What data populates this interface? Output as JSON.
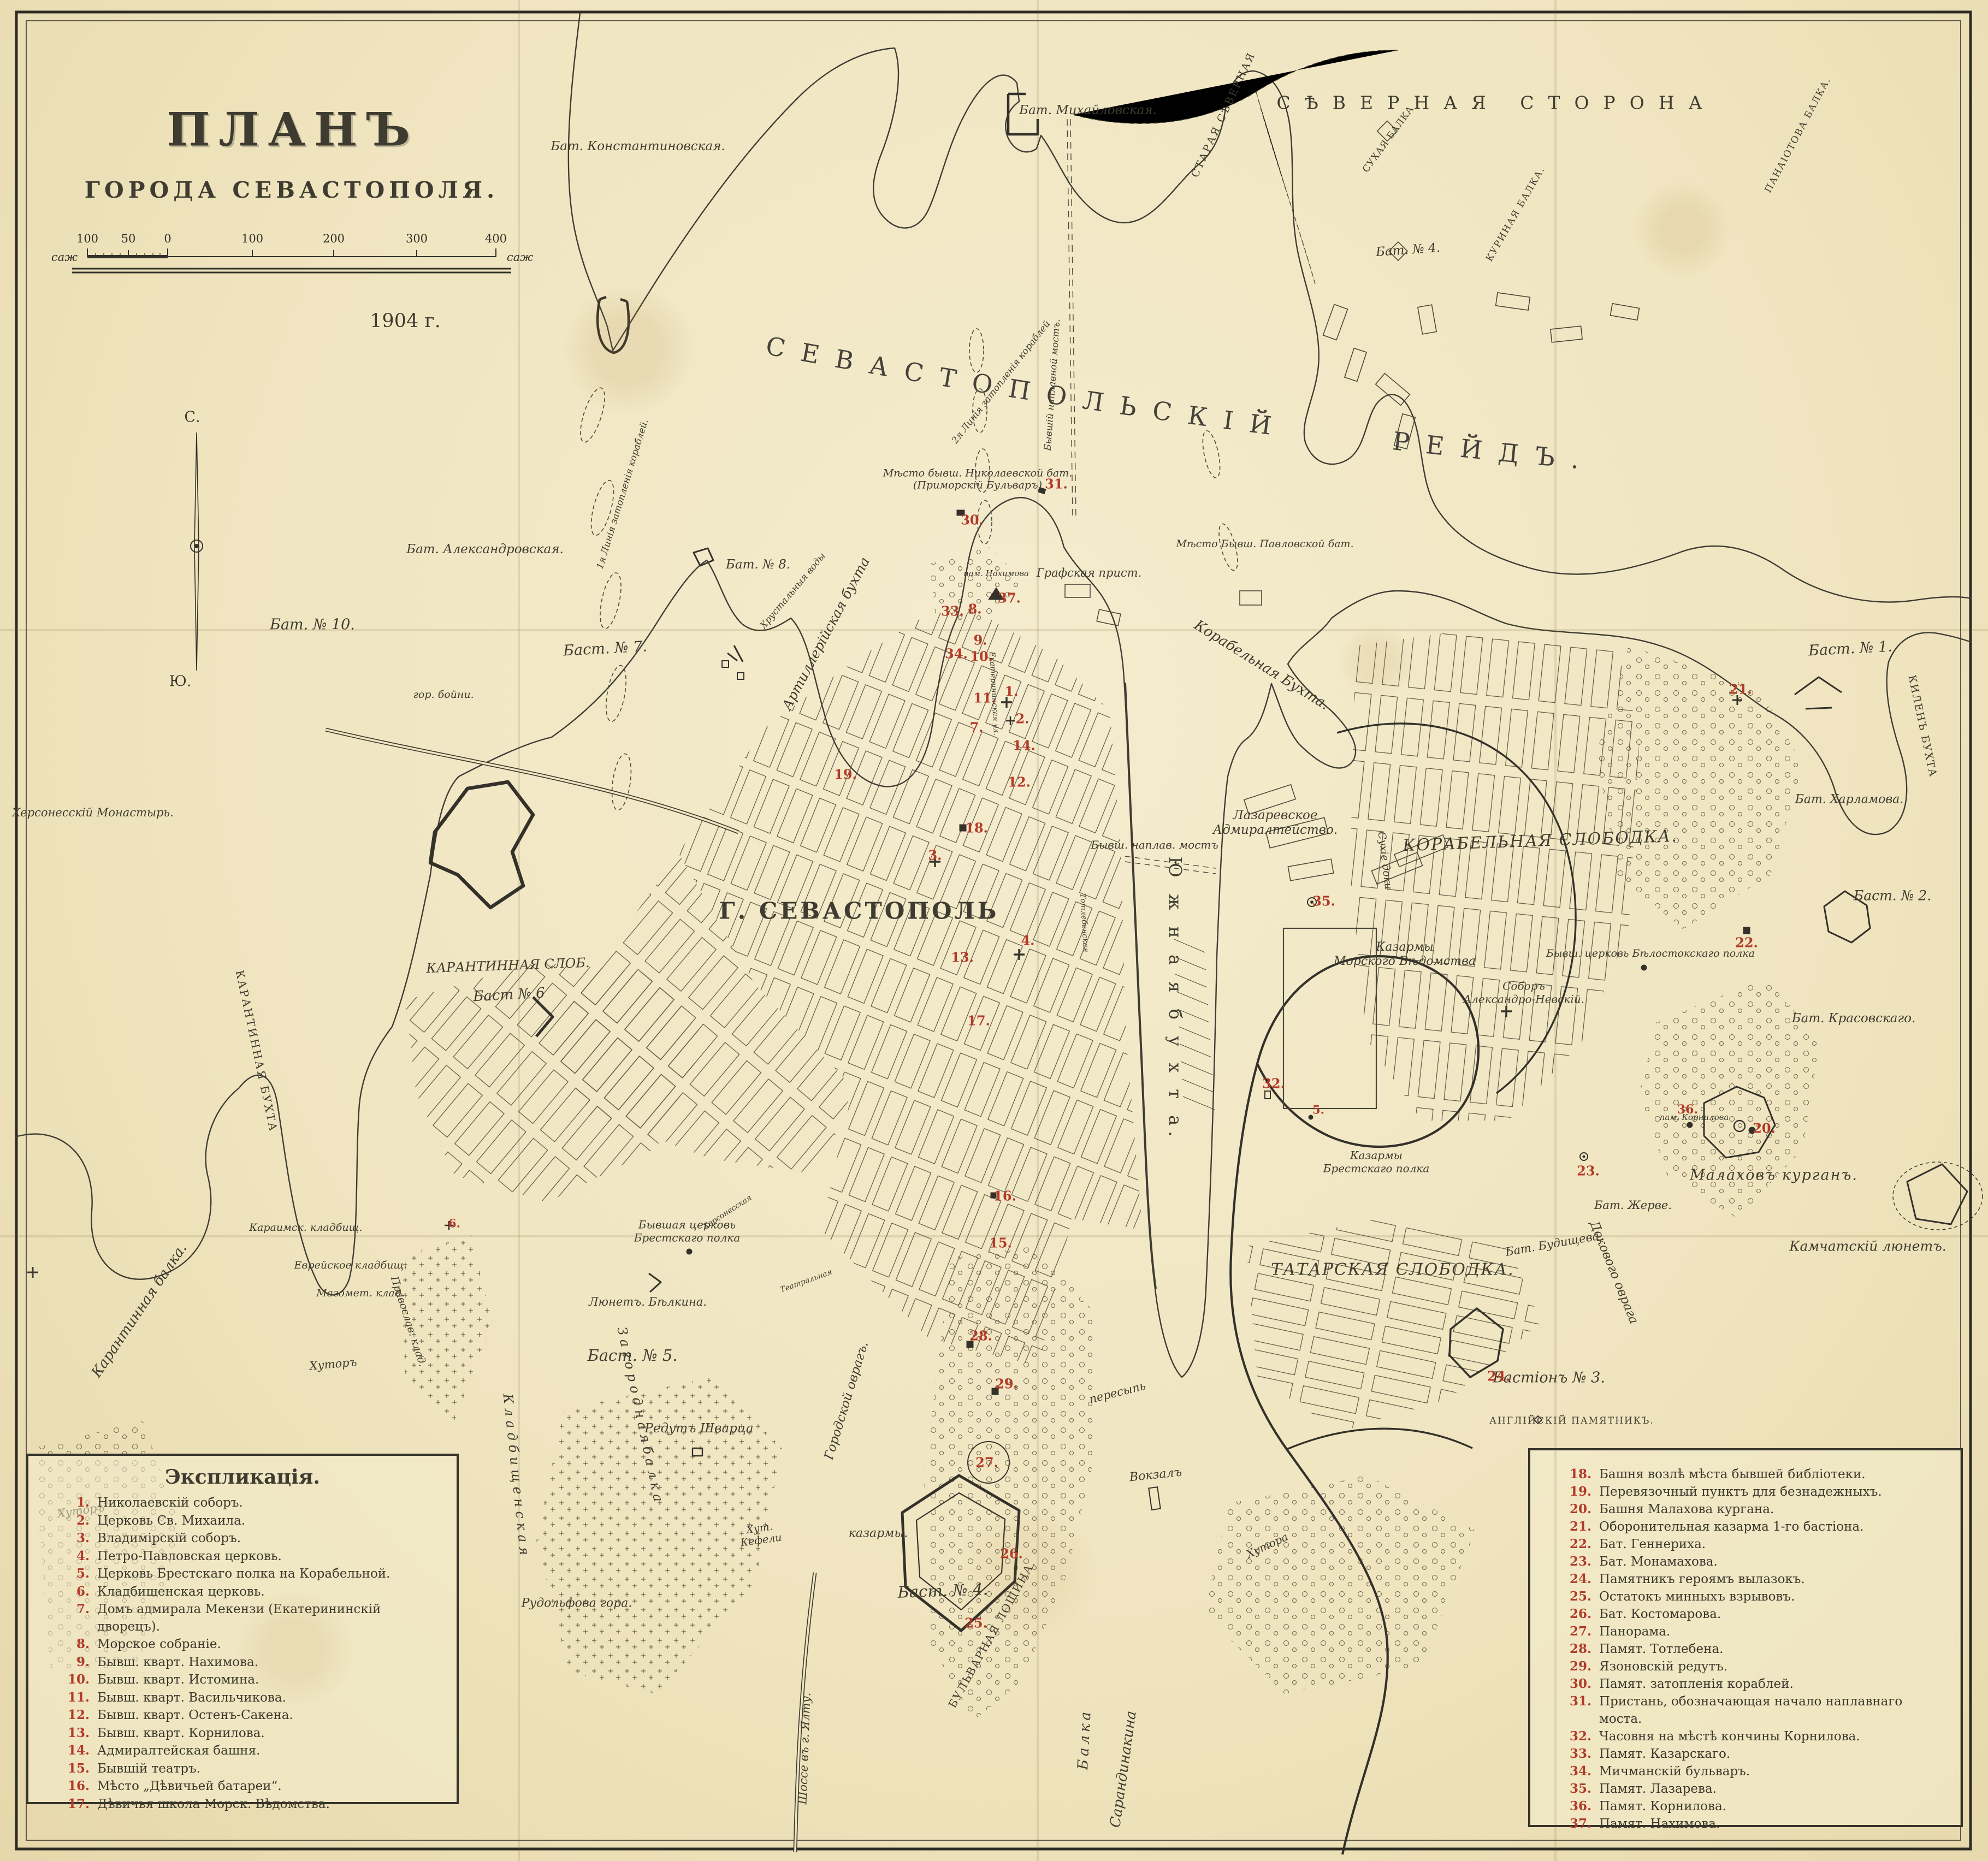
{
  "title": {
    "line1": "ПЛАНЪ",
    "line2": "ГОРОДА  СЕВАСТОПОЛЯ.",
    "year": "1904 г."
  },
  "scale_bar": {
    "unit_left": "саж",
    "unit_right": "саж",
    "ticks": [
      "100",
      "50",
      "0",
      "100",
      "200",
      "300",
      "400"
    ]
  },
  "compass": {
    "north": "С.",
    "south": "Ю."
  },
  "sea": {
    "reyd": "СЕВАСТОПОЛЬСКІЙ РЕЙДЪ.",
    "severnaya": "СѢВЕРНАЯ  СТОРОНА",
    "staraya": "СТАРАЯ СѢВЕРНАЯ"
  },
  "map_labels": {
    "g_sevastopol": "Г. СЕВАСТОПОЛЬ",
    "korabelnaya_slobodka": "КОРАБЕЛЬНАЯ  СЛОБОДКА.",
    "tatarskaya_slobodka": "ТАТАРСКАЯ  СЛОБОДКА.",
    "karantinnaya_slob": "КАРАНТИННАЯ СЛОБ.",
    "yuzhnaya_bukhta": "Ю ж н а я     б у х т а.",
    "korabelnaya_bukhta": "Корабельная  Бухта.",
    "artilleriyskaya_bukhta": "Артиллерійская бухта",
    "karantinnaya_bukhta": "КАРАНТИННАЯ  БУХТА",
    "kilen_bukhta": "КИЛЕНЪ  БУХТА",
    "karantinnaya_balka": "Карантинная  балка.",
    "suhaya_balka": "СУХАЯ БАЛКА",
    "kurinaya_balka": "КУРИНАЯ БАЛКА.",
    "panaiotova_balka": "ПАНАІОТОВА БАЛКА.",
    "balka_sarandi_1": "Балка",
    "balka_sarandi_2": "Сарандинакина",
    "zagorodnaya_balka": "З а г о р о д н а я   б а л к а",
    "kladbishchenskaya": "К л а д б и щ е н с к а я",
    "gorodskoy_ovrag": "Городской оврагъ.",
    "dokovogo_ovraga": "Докового оврага",
    "bulvarnaya_loshchina": "БУЛЬВАРНАЯ  ЛОЩИНА.",
    "peresyp": "пересыпь",
    "khrustalnye_vody": "Хрустальныя воды",
    "bat_konstantinovskaya": "Бат. Константиновская.",
    "bat_mikhailovskaya": "Бат. Михайловская.",
    "bat_n4_north": "Бат. № 4.",
    "bat_aleksandrovskaya": "Бат. Александровская.",
    "bat_n10": "Бат. № 10.",
    "bast_n7": "Баст. № 7.",
    "bat_n8": "Бат. № 8.",
    "gor_boyni": "гор. бойни.",
    "bast_n6": "Баст № 6",
    "bast_n5": "Баст. № 5.",
    "bast_n4": "Баст. № 4.",
    "bastion_n3": "Бастіонъ № 3.",
    "bast_n1": "Баст. № 1.",
    "bast_n2": "Баст. № 2.",
    "bat_kharlamova": "Бат. Харламова.",
    "bat_krasovskago": "Бат. Красовскаго.",
    "bat_zherve": "Бат. Жерве.",
    "bat_budishcheva": "Бат. Будищева",
    "malakhov_kurgan": "Малаховъ  курганъ.",
    "kamchatsky_lyunet": "Камчатскій  люнетъ.",
    "anglysky_pamyatnik": "АНГЛІЙСКІЙ  ПАМЯТНИКЪ.",
    "lyunet_belkina": "Люнетъ. Бѣлкина.",
    "redut_shvartsa": "Редутъ  Шварца",
    "mesto_nikolaevskoy": "Мѣсто бывш. Николаевской бат.\n(Приморскій Бульваръ)",
    "mesto_pavlovskoy": "Мѣсто Бывш. Павловской бат.",
    "grafskaya_prist": "Графская прист.",
    "pam_nakhimova": "пам. Нахимова",
    "pam_kornilova": "пам. Корнилова",
    "khersonessky_monastyr": "Херсонесскій  Монастырь.",
    "lazarevskoe": "Лазаревское\nАдмиралтейство.",
    "suhie_doki": "Сухіе  доки",
    "kazarmy_morskogo": "Казармы\nМорского Вѣдомства",
    "sobor_aleks_nevsky": "Соборъ\nАлександро-Невскій.",
    "tserkov_belostok": "Бывш. церковь Бѣлостокскаго полка",
    "kazarmy_brest": "Казармы\nБрестскаго полка",
    "tserkov_brest": "Бывшая церковь\nБрестскаго полка",
    "kazarmy_south": "казармы.",
    "vokzal": "Вокзалъ",
    "hutor_kefeli": "Хут.\nКефели",
    "rudolfova_gora": "Рудольфова гора.",
    "hutor_1": "Хуторъ",
    "hutor_2": "Хуторъ",
    "hutora": "Хутора",
    "karaimsk_kladb": "Караимск. кладбищ.",
    "evreyskoe_kladb": "Еврейское кладбищ.",
    "magomet_klad": "Магомет. клад.",
    "pravoslav_klad": "Православ. клад.",
    "shosse_yalta": "Шоссе въ г. Ялту.",
    "liniya1": "1я Линія затопленія кораблей.",
    "liniya2": "2я Линія затопленія кораблей",
    "naplavnoy_most_v": "Бывшій наплавной мостъ.",
    "naplav_most_s": "Бывш. наплав. мостъ",
    "ekaterininskaya": "Екатерининская  ул.",
    "khersonesskaya_ul": "Херсонесская",
    "teatralnaya_ul": "Театральная",
    "totlebenskaya_ul": "Тотлебенская"
  },
  "markers": {
    "m1": "1.",
    "m2": "2.",
    "m3": "3.",
    "m4": "4.",
    "m5": "5.",
    "m6": "6.",
    "m7": "7.",
    "m8": "8.",
    "m9": "9.",
    "m10": "10.",
    "m11": "11.",
    "m12": "12.",
    "m13": "13.",
    "m14": "14.",
    "m15": "15.",
    "m16": "16.",
    "m17": "17.",
    "m18": "18.",
    "m19": "19.",
    "m20": "20.",
    "m21": "21.",
    "m22": "22.",
    "m23": "23.",
    "m24": "24.",
    "m25": "25.",
    "m26": "26.",
    "m27": "27.",
    "m28": "28.",
    "m29": "29.",
    "m30": "30.",
    "m31": "31.",
    "m32": "32.",
    "m33": "33.",
    "m34": "34.",
    "m35": "35.",
    "m36": "36.",
    "m37": "37."
  },
  "legend_left": {
    "title": "Экспликація.",
    "items": [
      {
        "n": "1.",
        "text": "Николаевскій соборъ."
      },
      {
        "n": "2.",
        "text": "Церковь Св. Михаила."
      },
      {
        "n": "3.",
        "text": "Владимірскій соборъ."
      },
      {
        "n": "4.",
        "text": "Петро-Павловская церковь."
      },
      {
        "n": "5.",
        "text": "Церковь Брестскаго полка на Корабельной."
      },
      {
        "n": "6.",
        "text": "Кладбищенская церковь."
      },
      {
        "n": "7.",
        "text": "Домъ адмирала Мекензи (Екатерининскій дворецъ)."
      },
      {
        "n": "8.",
        "text": "Морское собраніе."
      },
      {
        "n": "9.",
        "text": "Бывш. кварт. Нахимова."
      },
      {
        "n": "10.",
        "text": "Бывш. кварт. Истомина."
      },
      {
        "n": "11.",
        "text": "Бывш. кварт. Васильчикова."
      },
      {
        "n": "12.",
        "text": "Бывш. кварт. Остенъ-Сакена."
      },
      {
        "n": "13.",
        "text": "Бывш. кварт. Корнилова."
      },
      {
        "n": "14.",
        "text": "Адмиралтейская башня."
      },
      {
        "n": "15.",
        "text": "Бывшій театръ."
      },
      {
        "n": "16.",
        "text": "Мѣсто „Дѣвичьей батареи“."
      },
      {
        "n": "17.",
        "text": "Дѣвичья школа Морск. Вѣдомства."
      }
    ]
  },
  "legend_right": {
    "items": [
      {
        "n": "18.",
        "text": "Башня возлѣ мѣста бывшей библіотеки."
      },
      {
        "n": "19.",
        "text": "Перевязочный пунктъ для безнадежныхъ."
      },
      {
        "n": "20.",
        "text": "Башня Малахова кургана."
      },
      {
        "n": "21.",
        "text": "Оборонительная казарма 1-го бастіона."
      },
      {
        "n": "22.",
        "text": "Бат. Геннериха."
      },
      {
        "n": "23.",
        "text": "Бат. Монамахова."
      },
      {
        "n": "24.",
        "text": "Памятникъ героямъ вылазокъ."
      },
      {
        "n": "25.",
        "text": "Остатокъ минныхъ взрывовъ."
      },
      {
        "n": "26.",
        "text": "Бат. Костомарова."
      },
      {
        "n": "27.",
        "text": "Панорама."
      },
      {
        "n": "28.",
        "text": "Памят. Тотлебена."
      },
      {
        "n": "29.",
        "text": "Язоновскій редутъ."
      },
      {
        "n": "30.",
        "text": "Памят. затопленія кораблей."
      },
      {
        "n": "31.",
        "text": "Пристань, обозначающая начало наплавнаго моста."
      },
      {
        "n": "32.",
        "text": "Часовня на мѣстѣ кончины Корнилова."
      },
      {
        "n": "33.",
        "text": "Памят. Казарскаго."
      },
      {
        "n": "34.",
        "text": "Мичманскій бульваръ."
      },
      {
        "n": "35.",
        "text": "Памят. Лазарева."
      },
      {
        "n": "36.",
        "text": "Памят. Корнилова."
      },
      {
        "n": "37.",
        "text": "Памят. Нахимова."
      }
    ]
  },
  "colors": {
    "paper": "#f0e5c0",
    "ink": "#3e3c30",
    "red": "#b33a28"
  }
}
